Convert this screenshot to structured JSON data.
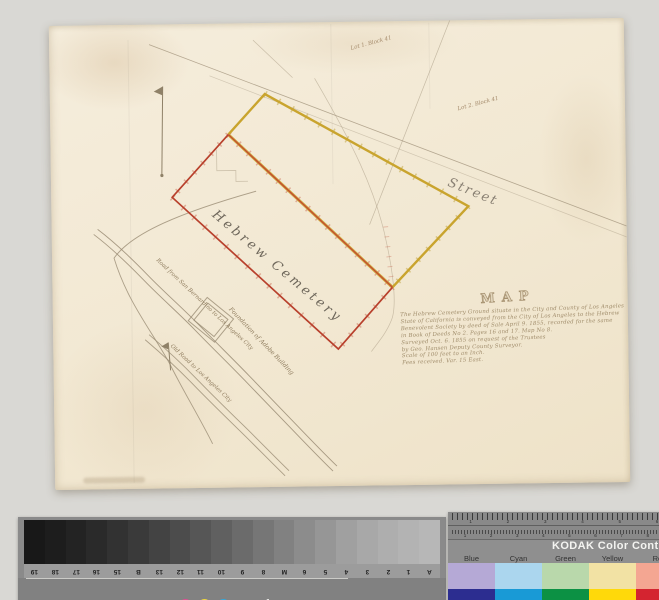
{
  "map": {
    "labels": {
      "street": "Street",
      "cemetery": "Hebrew Cemetery",
      "map_title": "MAP",
      "foundation": "Foundation of Adobe Building",
      "road1": "Road from San Bernardino to Los Angeles City",
      "road2": "Old Road to Los Angeles City",
      "lot_top": "Lot 1. Block 41",
      "lot_right": "Lot 2. Block 41"
    },
    "note_lines": [
      "The Hebrew Cemetery Ground situate in the City and County of Los Angeles",
      "State of California is conveyed from the City of Los Angeles to the Hebrew",
      "Benevolent Society by deed of Sale April 9. 1855, recorded for the same",
      "in Book of Deeds No 2. Pages 16 and 17. Map No 8.",
      "Surveyed Oct. 6. 1855 on request of the Trustees",
      "by Geo. Hansen Deputy County Surveyor.",
      "Scale of 100 feet to an Inch.",
      "Fees received. Var. 15 East."
    ],
    "colors": {
      "boundary_red": "#b8402c",
      "boundary_yellow": "#c9a42e",
      "pencil": "#a99b84",
      "ink": "#97825f",
      "paper": "#f2e8d2"
    }
  },
  "gray_scale_card": {
    "brand": "Kodak",
    "title": "KODAK Gray Scale",
    "dots": [
      {
        "label": "C",
        "color": "#33a8dc",
        "letter_color": "#ffffff"
      },
      {
        "label": "Y",
        "color": "#efd73e",
        "letter_color": "#94841a"
      },
      {
        "label": "M",
        "color": "#df4e93",
        "letter_color": "#ffffff"
      }
    ],
    "steps": [
      "#181818",
      "#1d1d1d",
      "#232323",
      "#2a2a2a",
      "#323232",
      "#3a3a3a",
      "#434343",
      "#4c4c4c",
      "#565656",
      "#606060",
      "#6b6b6b",
      "#767676",
      "#818181",
      "#8c8c8c",
      "#969696",
      "#a0a0a0",
      "#a8a8a8",
      "#aeaeae",
      "#b3b3b3",
      "#b7b7b7"
    ],
    "step_labels": [
      "19",
      "18",
      "17",
      "16",
      "15",
      "B",
      "13",
      "12",
      "11",
      "10",
      "9",
      "8",
      "M",
      "6",
      "5",
      "4",
      "3",
      "2",
      "1",
      "A"
    ]
  },
  "color_control_card": {
    "title": "KODAK Color Control Patches",
    "columns": [
      {
        "label": "Blue",
        "tint": "#b5a9d6",
        "solid": "#2c2d90"
      },
      {
        "label": "Cyan",
        "tint": "#abd6ee",
        "solid": "#199ad6"
      },
      {
        "label": "Green",
        "tint": "#b9d8ab",
        "solid": "#0c9144"
      },
      {
        "label": "Yellow",
        "tint": "#f2e2a4",
        "solid": "#ffd90a"
      },
      {
        "label": "Red",
        "tint": "#f4a692",
        "solid": "#d42430"
      }
    ],
    "ruler_numbers_top": [
      "1",
      "2",
      "3",
      "4",
      "5",
      "6",
      "7"
    ],
    "ruler_numbers_bottom": [
      "1",
      "2",
      "3",
      "4",
      "5",
      "6",
      "7",
      "8",
      "9",
      "10"
    ]
  }
}
